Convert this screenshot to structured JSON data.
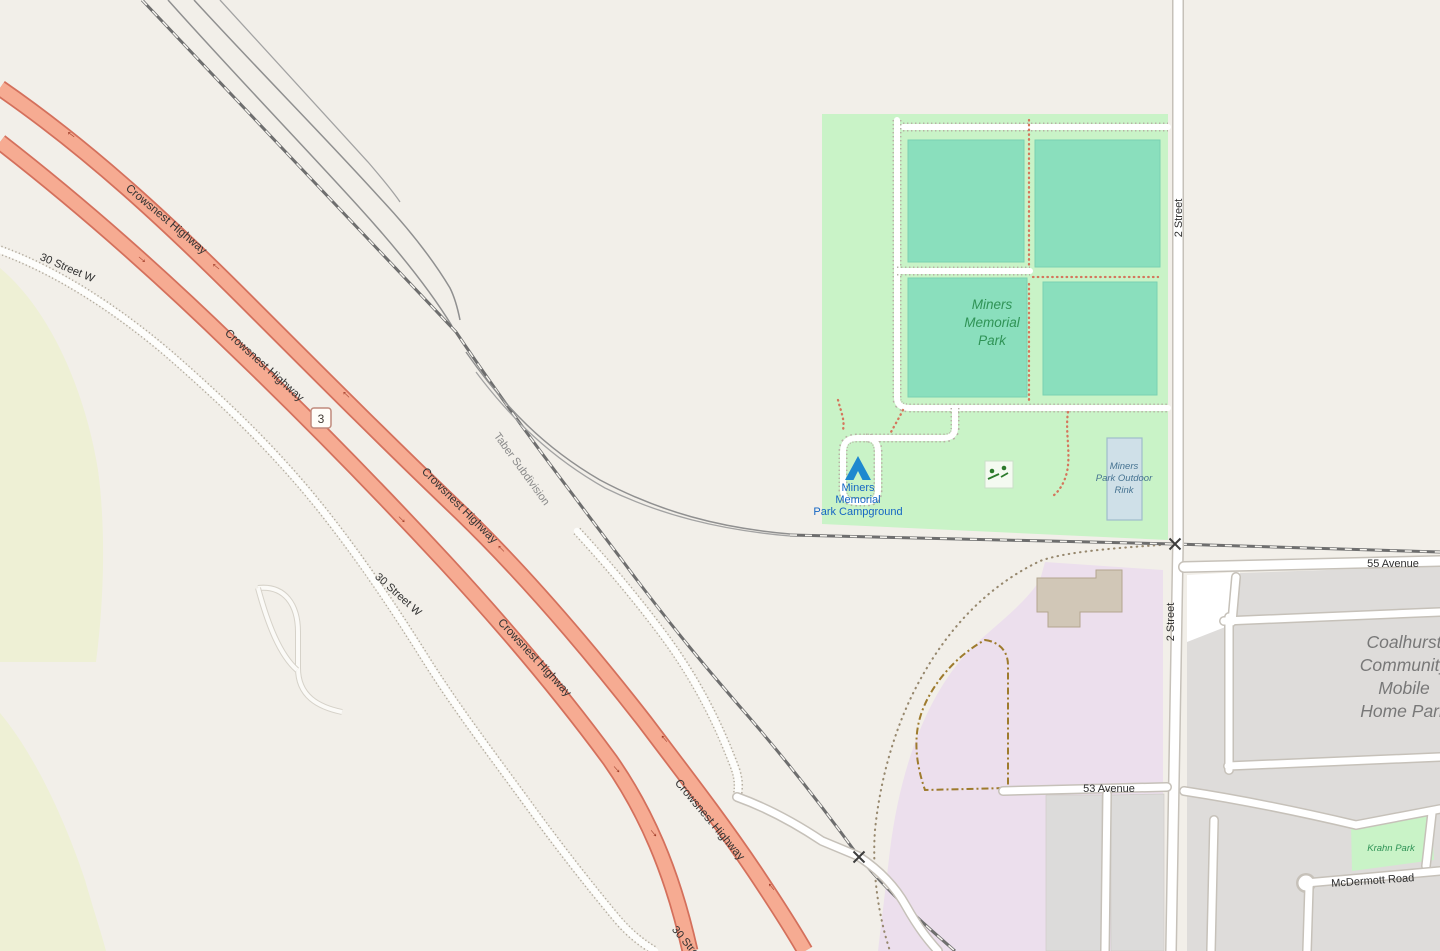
{
  "labels": {
    "highway": {
      "name": "Crowsnest Highway",
      "shield": "3",
      "oneway_arrow": "→"
    },
    "railway": {
      "name": "Taber Subdivision"
    },
    "streets": {
      "thirty_w": "30 Street W",
      "two": "2 Street",
      "fifty_five": "55 Avenue",
      "fifty_three": "53 Avenue",
      "mcdermott": "McDermott Road"
    },
    "park": {
      "line1": "Miners",
      "line2": "Memorial",
      "line3": "Park"
    },
    "campground": {
      "line1": "Miners",
      "line2": "Memorial",
      "line3": "Park Campground"
    },
    "rink": {
      "line1": "Miners",
      "line2": "Park Outdoor",
      "line3": "Rink"
    },
    "krahn_park": "Krahn Park",
    "mobile_home_park": {
      "line1": "Coalhurst",
      "line2": "Community",
      "line3": "Mobile",
      "line4": "Home Park"
    }
  },
  "colors": {
    "background": "#f2efe9",
    "farmland": "#eef0d5",
    "park_green": "#c9f3c7",
    "sports_pitch": "#8adfbd",
    "school_area": "#ecdfed",
    "residential": "#dedcda",
    "building": "#d1c7b7",
    "rink_fill": "#cfe0e8",
    "trunk_road_fill": "#f6ab92",
    "trunk_road_casing": "#d4705c",
    "railway_gray": "#6e6e6e",
    "track_gold": "#9e7b2d",
    "path_red_dots": "#d4765c",
    "park_label_green": "#2f9356",
    "poi_blue": "#1566c4",
    "oneway_arrow": "#a03c28"
  }
}
